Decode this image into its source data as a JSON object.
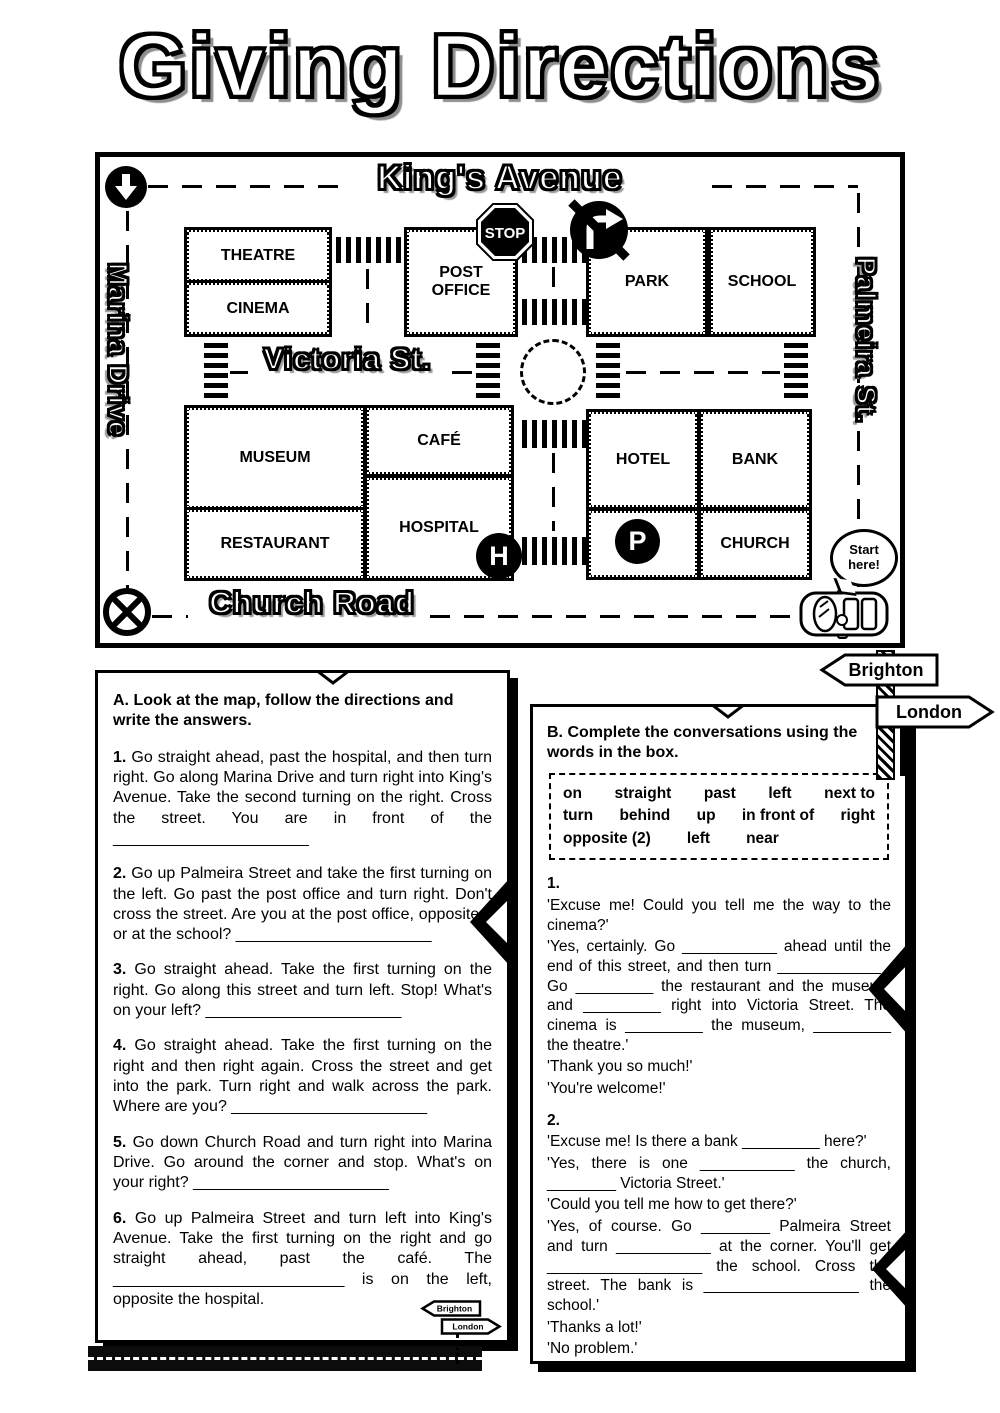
{
  "title": "Giving Directions",
  "map": {
    "street_top": "King's Avenue",
    "street_left": "Marina Drive",
    "street_right": "Palmeira St.",
    "street_middle": "Victoria St.",
    "street_bottom": "Church Road",
    "buildings": {
      "theatre": "THEATRE",
      "cinema": "CINEMA",
      "post_office": "POST OFFICE",
      "park": "PARK",
      "school": "SCHOOL",
      "museum": "MUSEUM",
      "cafe": "CAFÉ",
      "restaurant": "RESTAURANT",
      "hospital": "HOSPITAL",
      "hotel": "HOTEL",
      "bank": "BANK",
      "church": "CHURCH"
    },
    "signs": {
      "stop": "STOP",
      "hospital_badge": "H",
      "parking_badge": "P"
    },
    "start_bubble_line1": "Start",
    "start_bubble_line2": "here!"
  },
  "signpost": {
    "left": "Brighton",
    "right": "London"
  },
  "section_a": {
    "heading": "A. Look at the map, follow the directions and write the answers.",
    "items": [
      {
        "num": "1.",
        "text": "Go straight ahead, past the hospital, and then turn right. Go along Marina Drive and turn right into King's Avenue. Take the second turning on the right. Cross the street. You are in front of the ______________________"
      },
      {
        "num": "2.",
        "text": "Go up Palmeira Street and take the first turning on the left. Go past the post office and turn right. Don't cross the street. Are you at the post office, opposite it or at the school? ______________________"
      },
      {
        "num": "3.",
        "text": "Go straight ahead. Take the first turning on the right. Go along this street and turn left. Stop! What's on your left? ______________________"
      },
      {
        "num": "4.",
        "text": "Go straight ahead. Take the first turning on the right and then right again. Cross the street and get into the park. Turn right and walk across the park. Where are you? ______________________"
      },
      {
        "num": "5.",
        "text": "Go down Church Road and turn right into Marina Drive. Go around the corner and stop. What's on your right? ______________________"
      },
      {
        "num": "6.",
        "text": "Go up Palmeira Street and turn left into King's Avenue. Take the first turning on the right and go straight ahead, past the café. The __________________________ is on the left, opposite the hospital."
      }
    ]
  },
  "section_b": {
    "heading": "B. Complete the conversations using the words in the box.",
    "word_box": {
      "row1": [
        "on",
        "straight",
        "past",
        "left",
        "next to"
      ],
      "row2": [
        "turn",
        "behind",
        "up",
        "in front of",
        "right"
      ],
      "row3": [
        "opposite (2)",
        "left",
        "near"
      ]
    },
    "conversations": [
      {
        "num": "1.",
        "lines": [
          "'Excuse me! Could you tell me the way to the cinema?'",
          "'Yes, certainly. Go ___________ ahead until the end of this street, and then turn ____________ . Go _________ the restaurant and the museum and _________ right into Victoria Street. The cinema is _________ the museum, _________ the theatre.'",
          "'Thank you so much!'",
          "'You're welcome!'"
        ]
      },
      {
        "num": "2.",
        "lines": [
          "'Excuse me! Is there a bank _________ here?'",
          "'Yes, there is one ___________ the church, ________ Victoria Street.'",
          "'Could you tell me how to get there?'",
          "'Yes, of course. Go ________ Palmeira Street and turn ___________ at the corner. You'll get __________________ the school. Cross the street. The bank is __________________ the school.'",
          "'Thanks a lot!'",
          "'No problem.'"
        ]
      }
    ]
  }
}
